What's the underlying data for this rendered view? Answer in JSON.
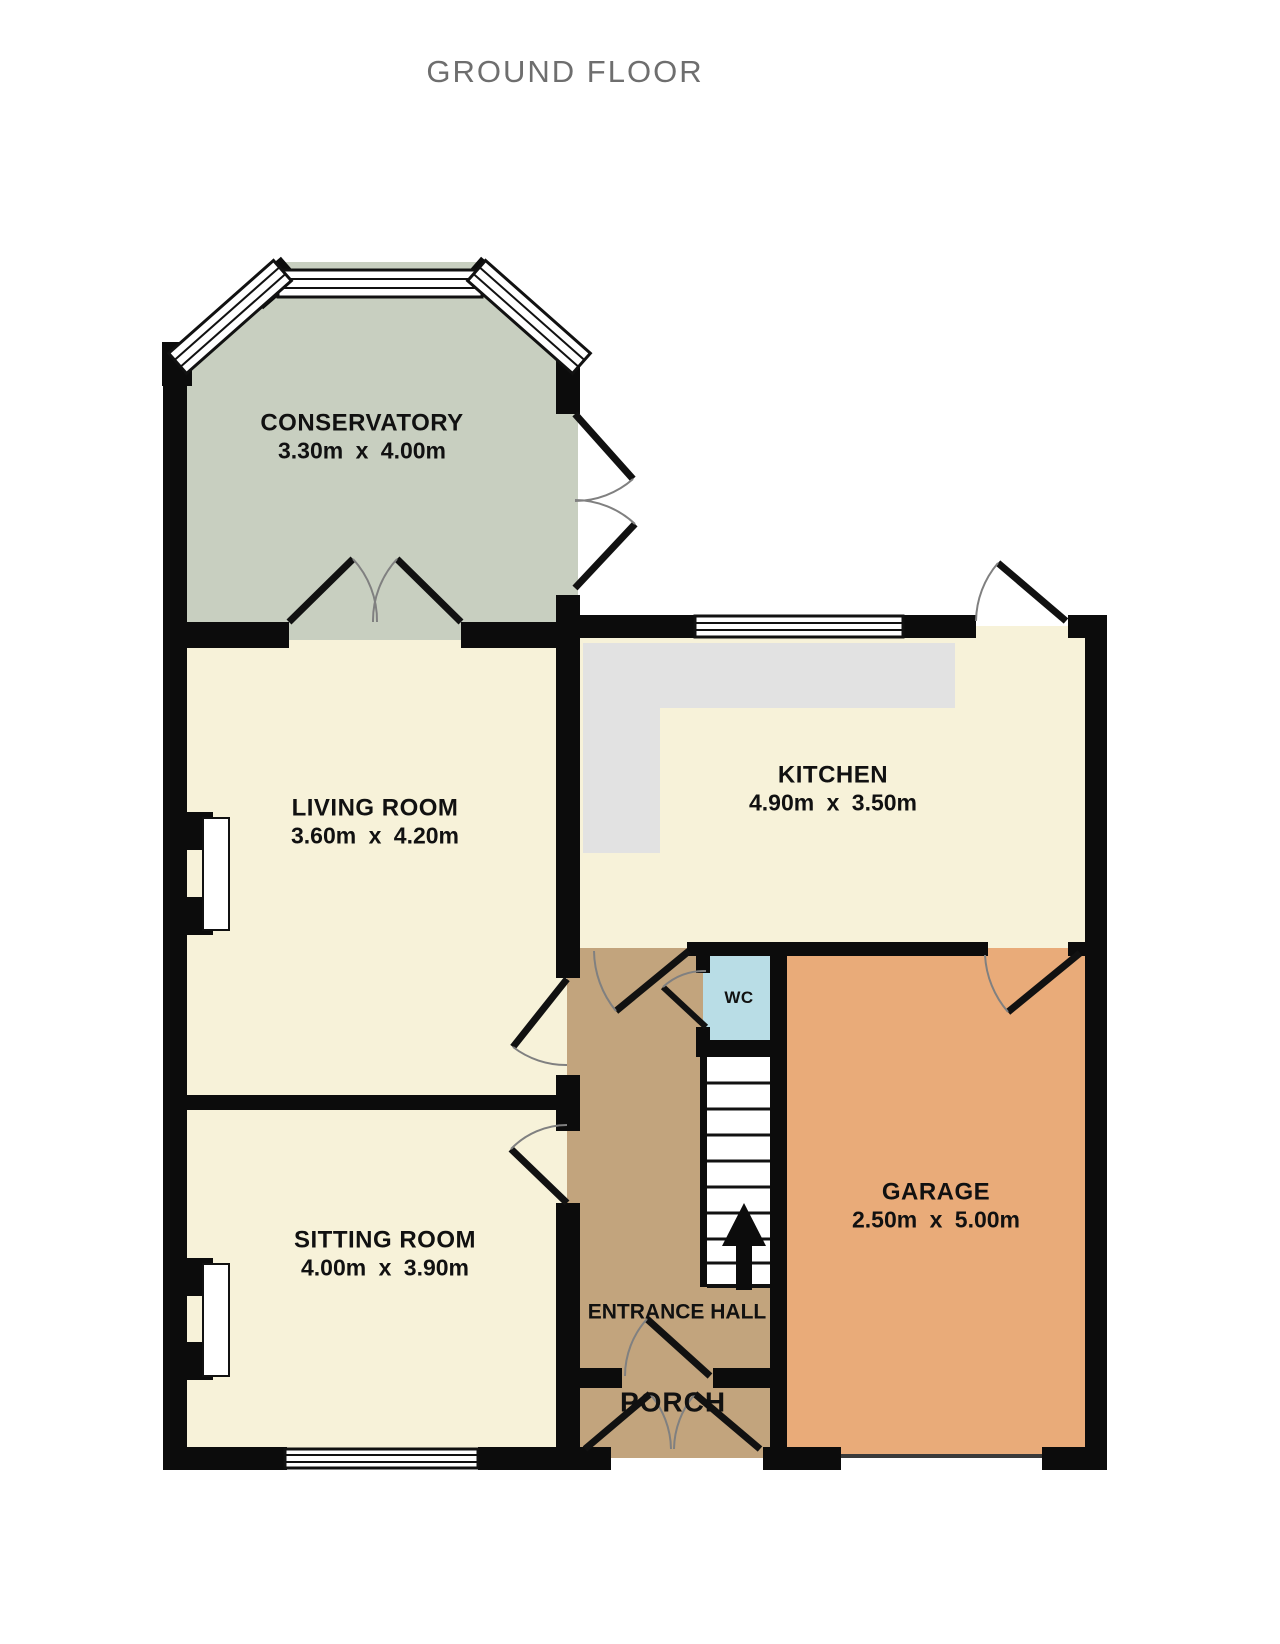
{
  "title": "GROUND FLOOR",
  "rooms": {
    "conservatory": {
      "name": "CONSERVATORY",
      "dims": "3.30m x 4.00m"
    },
    "living_room": {
      "name": "LIVING ROOM",
      "dims": "3.60m x 4.20m"
    },
    "kitchen": {
      "name": "KITCHEN",
      "dims": "4.90m x 3.50m"
    },
    "sitting_room": {
      "name": "SITTING ROOM",
      "dims": "4.00m x 3.90m"
    },
    "garage": {
      "name": "GARAGE",
      "dims": "2.50m x 5.00m"
    },
    "wc": {
      "name": "WC"
    },
    "entrance_hall": {
      "name": "ENTRANCE HALL"
    },
    "porch": {
      "name": "PORCH"
    }
  },
  "palette": {
    "room_cream": "#f7f2d9",
    "conservatory_sage": "#c8cfc0",
    "hall_tan": "#c2a47d",
    "garage_orange": "#e9ab79",
    "wc_blue": "#b9dde6",
    "counter_gray": "#e2e2e2",
    "wall_black": "#0c0c0c",
    "stair_white": "#ffffff",
    "title_gray": "#6e6e6e"
  }
}
